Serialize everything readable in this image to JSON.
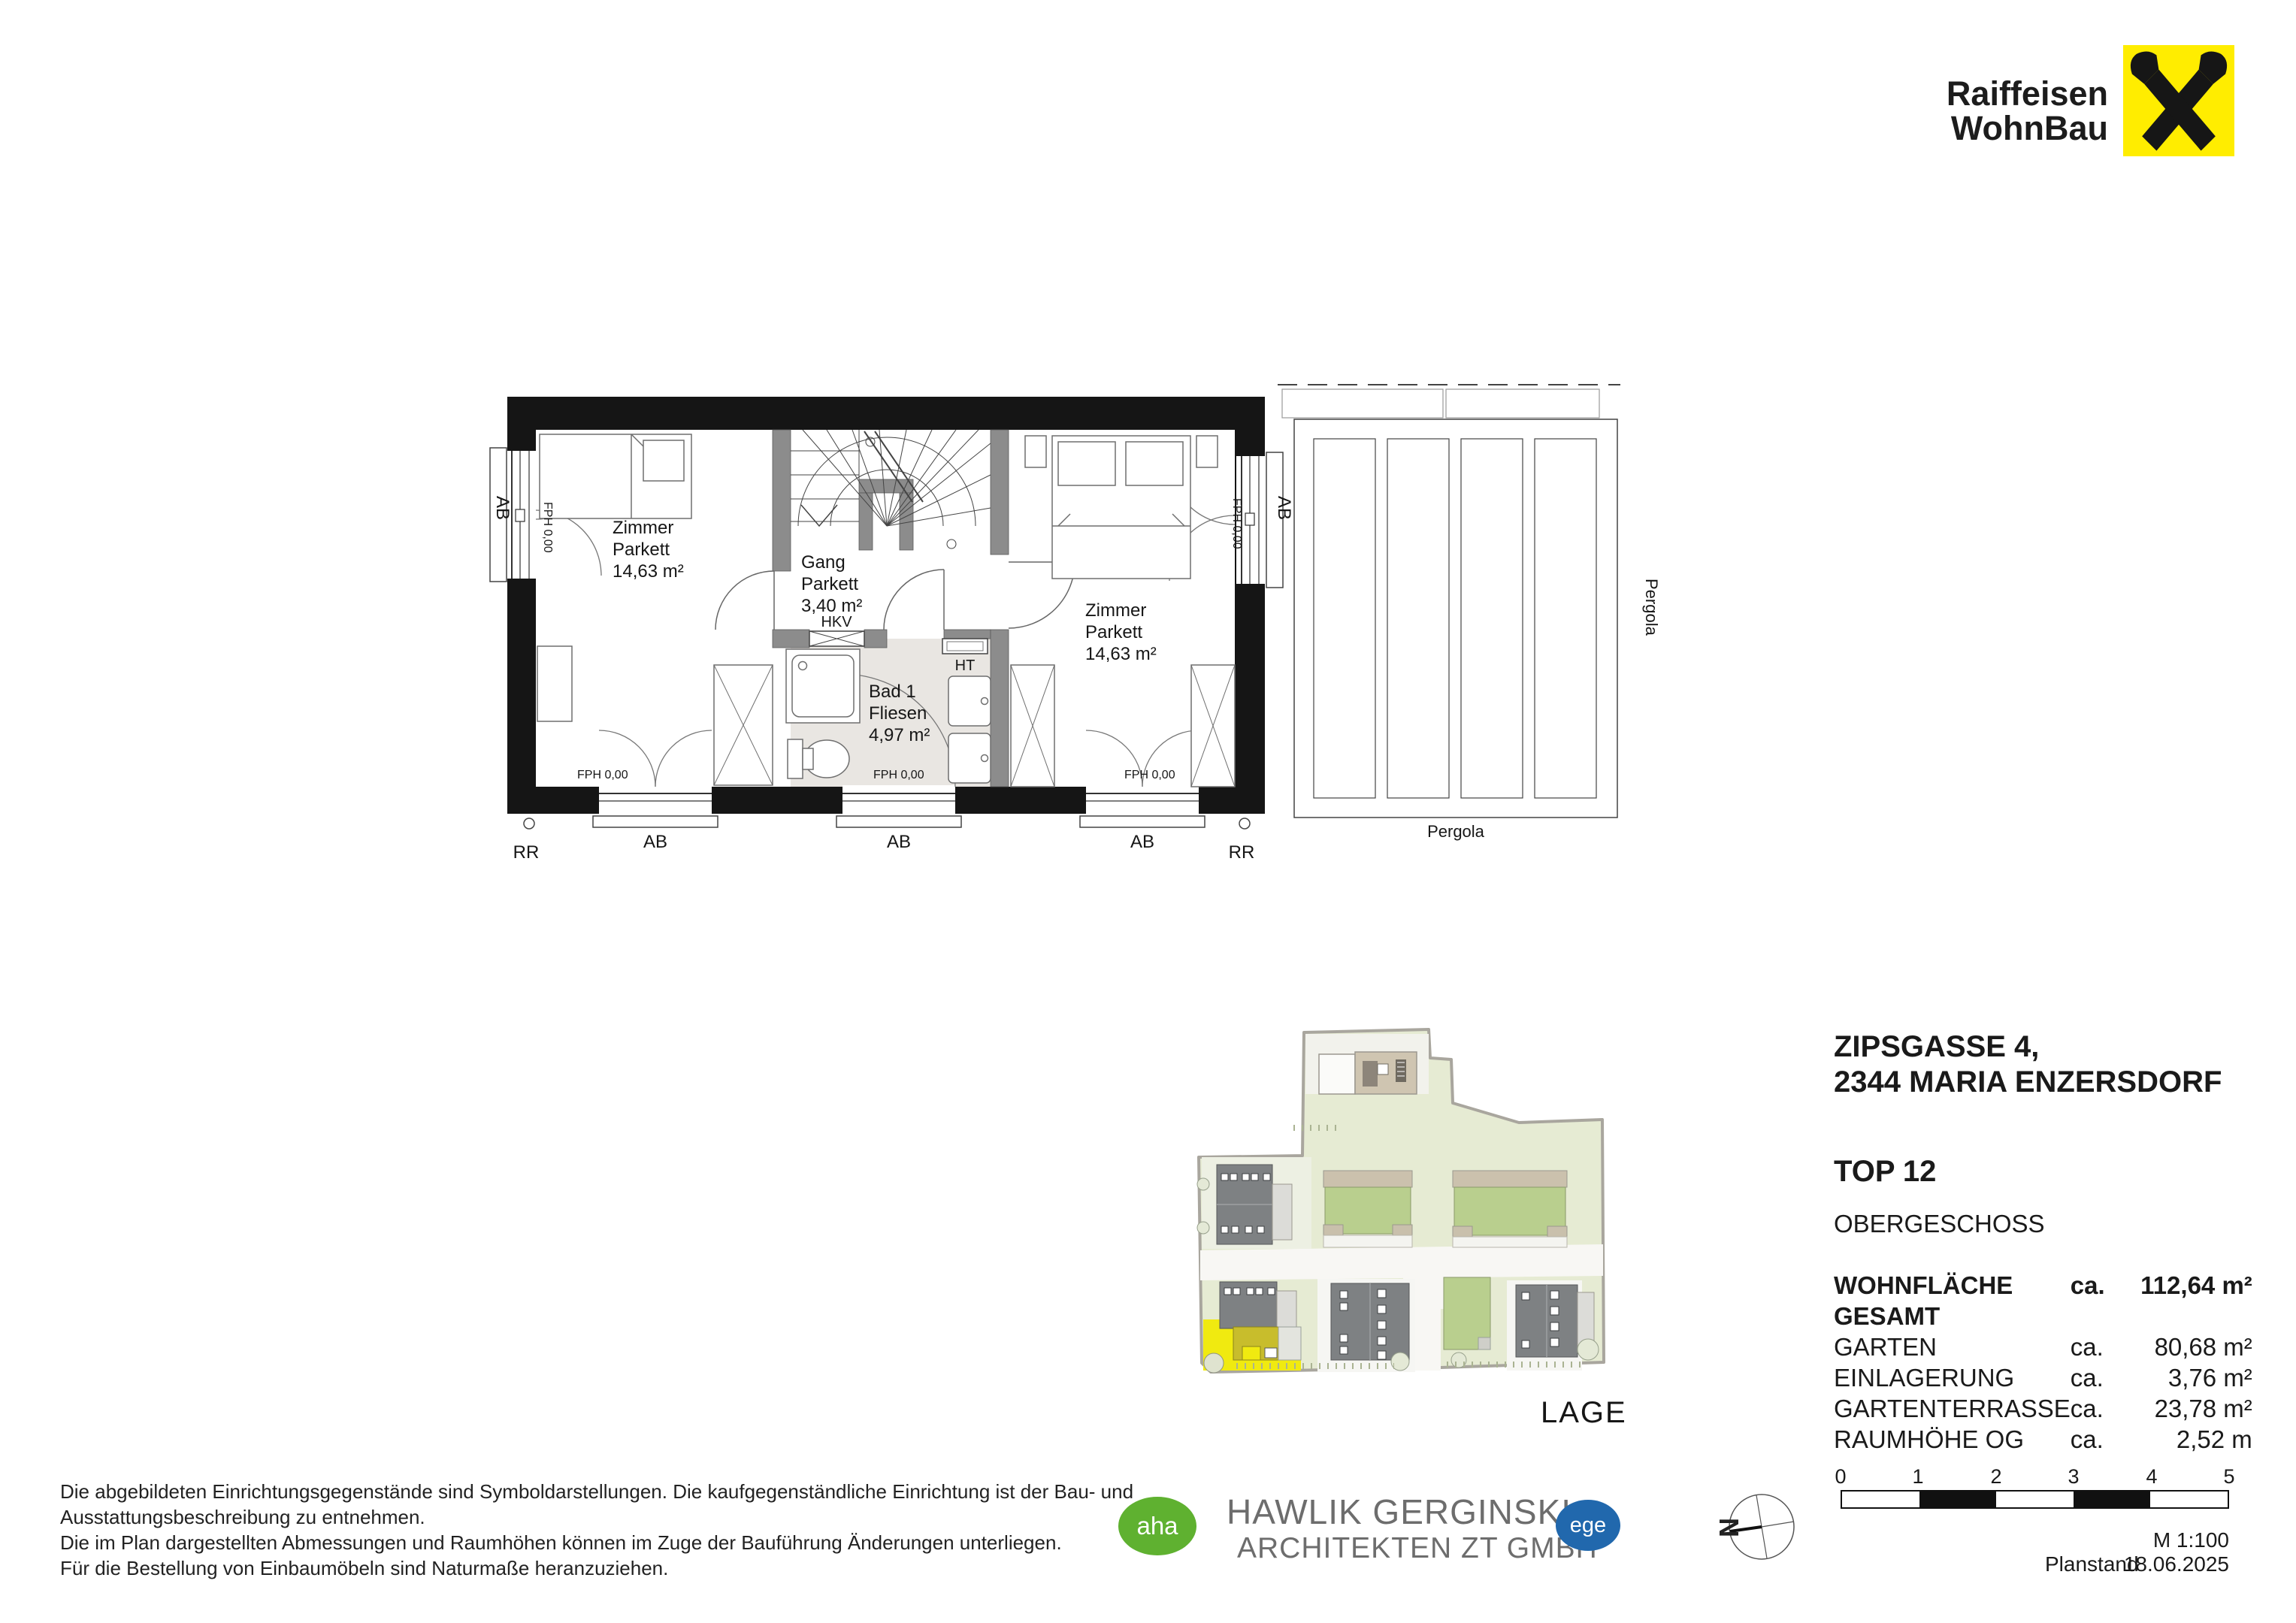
{
  "brand": {
    "name_line1": "Raiffeisen",
    "name_line2": "WohnBau",
    "logo_color": "#ffed00"
  },
  "floorplan": {
    "rooms": [
      {
        "name": "Zimmer",
        "finish": "Parkett",
        "area": "14,63 m²"
      },
      {
        "name": "Gang",
        "finish": "Parkett",
        "area": "3,40 m²"
      },
      {
        "name": "Zimmer",
        "finish": "Parkett",
        "area": "14,63 m²"
      },
      {
        "name": "Bad 1",
        "finish": "Fliesen",
        "area": "4,97 m²"
      }
    ],
    "labels": {
      "hkv": "HKV",
      "ht": "HT",
      "fph": "FPH 0,00",
      "ab": "AB",
      "rr": "RR",
      "pergola": "Pergola"
    }
  },
  "siteplan": {
    "caption": "LAGE",
    "highlight_color": "#f0ea10"
  },
  "info": {
    "address_line1": "ZIPSGASSE 4,",
    "address_line2": "2344 MARIA ENZERSDORF",
    "unit": "TOP 12",
    "level": "OBERGESCHOSS",
    "metrics": [
      {
        "label": "WOHNFLÄCHE GESAMT",
        "approx": "ca.",
        "value": "112,64 m²"
      },
      {
        "label": "GARTEN",
        "approx": "ca.",
        "value": "80,68 m²"
      },
      {
        "label": "EINLAGERUNG",
        "approx": "ca.",
        "value": "3,76 m²"
      },
      {
        "label": "GARTENTERRASSE",
        "approx": "ca.",
        "value": "23,78 m²"
      },
      {
        "label": "RAUMHÖHE OG",
        "approx": "ca.",
        "value": "2,52 m"
      }
    ]
  },
  "disclaimer": {
    "line1": "Die abgebildeten Einrichtungsgegenstände sind Symboldarstellungen. Die kaufgegenständliche Einrichtung ist der Bau- und",
    "line2": "Ausstattungsbeschreibung zu entnehmen.",
    "line3": "Die im Plan dargestellten Abmessungen und Raumhöhen können im Zuge der Bauführung Änderungen unterliegen.",
    "line4": "Für die Bestellung von Einbaumöbeln sind Naturmaße heranzuziehen."
  },
  "architect": {
    "badge_left": "aha",
    "badge_left_color": "#5fb130",
    "name_line1": "HAWLIK GERGINSKI",
    "name_line2": "ARCHITEKTEN ZT GMBH",
    "badge_right": "ege",
    "badge_right_color": "#2168ad"
  },
  "north": {
    "label": "N"
  },
  "scale": {
    "ticks": [
      "0",
      "1",
      "2",
      "3",
      "4",
      "5"
    ],
    "ratio": "M 1:100",
    "planstand_label": "Planstand",
    "planstand_date": "18.06.2025"
  }
}
